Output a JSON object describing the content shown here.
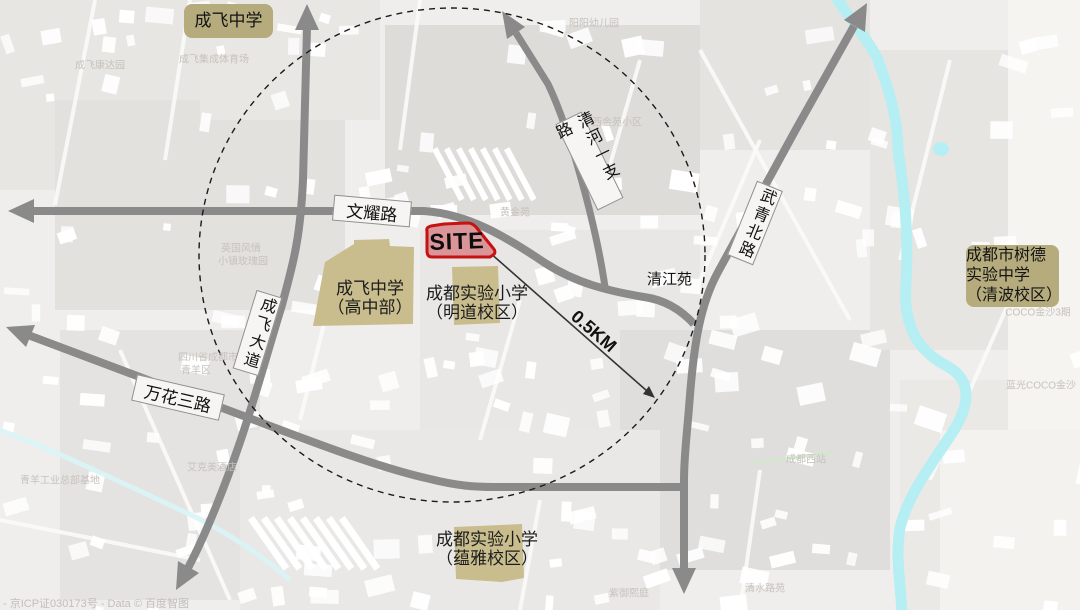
{
  "roads": {
    "wenyao": "文耀路",
    "wanhua": "万花三路",
    "chengfei_dadao": "成飞大道",
    "qinghe": "清河一支路",
    "wuqing": "武青北路"
  },
  "site": {
    "label": "SITE"
  },
  "distance": {
    "label": "0.5KM"
  },
  "schools": {
    "chengfei": "成飞中学",
    "gaozhong_line1": "成飞中学",
    "gaozhong_line2": "（高中部）",
    "mingdao_line1": "成都实验小学",
    "mingdao_line2": "（明道校区）",
    "yunya_line1": "成都实验小学",
    "yunya_line2": "（蕴雅校区）",
    "shude_line1": "成都市树德实验中学",
    "shude_line2": "（清波校区）"
  },
  "places": {
    "qingjiangyuan": "清江苑"
  },
  "footer": {
    "copyright": "- 京ICP证030173号 - Data © 百度智图"
  },
  "basemap": {
    "labels": [
      {
        "text": "成飞康达园",
        "x": 100,
        "y": 64
      },
      {
        "text": "成飞集成体育场",
        "x": 214,
        "y": 58
      },
      {
        "text": "英国风情",
        "x": 241,
        "y": 247
      },
      {
        "text": "小镇玫瑰园",
        "x": 243,
        "y": 260
      },
      {
        "text": "阳阳幼儿园",
        "x": 594,
        "y": 22
      },
      {
        "text": "西金苑小区",
        "x": 617,
        "y": 121
      },
      {
        "text": "黄金苑",
        "x": 515,
        "y": 211
      },
      {
        "text": "四川省成都市",
        "x": 208,
        "y": 356
      },
      {
        "text": "青羊区",
        "x": 196,
        "y": 369
      },
      {
        "text": "青羊工业总部基地",
        "x": 60,
        "y": 479
      },
      {
        "text": "艾克美酒店",
        "x": 212,
        "y": 466
      },
      {
        "text": "清水路苑",
        "x": 765,
        "y": 587
      },
      {
        "text": "紫御熙庭",
        "x": 629,
        "y": 592
      },
      {
        "text": "COCO金沙3期",
        "x": 1038,
        "y": 311
      },
      {
        "text": "蓝光COCO金沙",
        "x": 1041,
        "y": 384
      },
      {
        "text": "成都西站",
        "x": 806,
        "y": 458
      }
    ]
  },
  "colors": {
    "road": "#8a8a8a",
    "river": "#b5eef3",
    "site_fill": "#db9598",
    "site_stroke": "#c51212",
    "school_fill": "#c9bd8e",
    "poi_box": "#b5ab7d",
    "ring": "#1a1a1a",
    "box_bg": "#f6f5f3",
    "box_border": "#8f8f8f",
    "basemap_label": "#c6c2bd"
  }
}
